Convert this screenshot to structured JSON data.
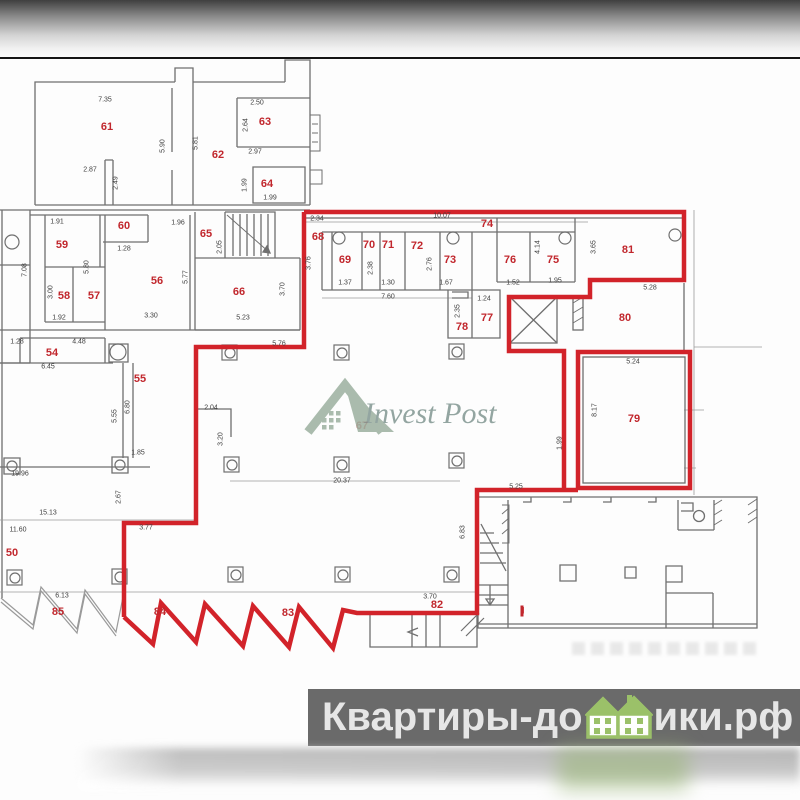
{
  "watermark": {
    "brand": "Invest Post"
  },
  "banner": {
    "left": "Квартиры-до",
    "right": "ики.рф"
  },
  "colors": {
    "highlight_red": "#d2232a",
    "room_label_red": "#c1272d",
    "wall_gray": "#6f6f6f",
    "banner_bg": "#6a6a6a",
    "banner_text": "#e6e6e6",
    "banner_house_green": "#9bc169",
    "logo_sage": "#9fb3a3"
  },
  "plan": {
    "rooms": [
      {
        "label": "61",
        "x": 107,
        "y": 127
      },
      {
        "label": "62",
        "x": 218,
        "y": 155
      },
      {
        "label": "63",
        "x": 265,
        "y": 122
      },
      {
        "label": "64",
        "x": 267,
        "y": 184
      },
      {
        "label": "59",
        "x": 62,
        "y": 245
      },
      {
        "label": "60",
        "x": 124,
        "y": 226
      },
      {
        "label": "65",
        "x": 206,
        "y": 234
      },
      {
        "label": "56",
        "x": 157,
        "y": 281
      },
      {
        "label": "58",
        "x": 64,
        "y": 296
      },
      {
        "label": "57",
        "x": 94,
        "y": 296
      },
      {
        "label": "66",
        "x": 239,
        "y": 292
      },
      {
        "label": "54",
        "x": 52,
        "y": 353
      },
      {
        "label": "55",
        "x": 140,
        "y": 379
      },
      {
        "label": "50",
        "x": 12,
        "y": 553
      },
      {
        "label": "85",
        "x": 58,
        "y": 612
      },
      {
        "label": "84",
        "x": 160,
        "y": 612
      },
      {
        "label": "83",
        "x": 288,
        "y": 613
      },
      {
        "label": "82",
        "x": 437,
        "y": 605
      },
      {
        "label": "68",
        "x": 318,
        "y": 237
      },
      {
        "label": "69",
        "x": 345,
        "y": 260
      },
      {
        "label": "70",
        "x": 369,
        "y": 245
      },
      {
        "label": "71",
        "x": 388,
        "y": 245
      },
      {
        "label": "72",
        "x": 417,
        "y": 246
      },
      {
        "label": "73",
        "x": 450,
        "y": 260
      },
      {
        "label": "74",
        "x": 487,
        "y": 224
      },
      {
        "label": "76",
        "x": 510,
        "y": 260
      },
      {
        "label": "75",
        "x": 553,
        "y": 260
      },
      {
        "label": "77",
        "x": 487,
        "y": 318
      },
      {
        "label": "78",
        "x": 462,
        "y": 327
      },
      {
        "label": "81",
        "x": 628,
        "y": 250
      },
      {
        "label": "80",
        "x": 625,
        "y": 318
      },
      {
        "label": "79",
        "x": 634,
        "y": 419
      },
      {
        "label": "67",
        "x": 362,
        "y": 426
      },
      {
        "label": "II",
        "x": 522,
        "y": 611,
        "cls": "unit"
      }
    ],
    "dims": [
      {
        "t": "7.35",
        "x": 105,
        "y": 100
      },
      {
        "t": "2.87",
        "x": 90,
        "y": 170
      },
      {
        "t": "5.90",
        "x": 163,
        "y": 146,
        "v": 1
      },
      {
        "t": "2.49",
        "x": 116,
        "y": 183,
        "v": 1
      },
      {
        "t": "5.81",
        "x": 196,
        "y": 143,
        "v": 1
      },
      {
        "t": "2.50",
        "x": 257,
        "y": 103
      },
      {
        "t": "2.64",
        "x": 246,
        "y": 125,
        "v": 1
      },
      {
        "t": "2.97",
        "x": 255,
        "y": 152
      },
      {
        "t": "1.99",
        "x": 245,
        "y": 185,
        "v": 1
      },
      {
        "t": "1.99",
        "x": 270,
        "y": 198
      },
      {
        "t": "1.91",
        "x": 57,
        "y": 222
      },
      {
        "t": "1.96",
        "x": 178,
        "y": 223
      },
      {
        "t": "2.05",
        "x": 220,
        "y": 247,
        "v": 1
      },
      {
        "t": "5.80",
        "x": 87,
        "y": 267,
        "v": 1
      },
      {
        "t": "3.00",
        "x": 51,
        "y": 292,
        "v": 1
      },
      {
        "t": "1.92",
        "x": 59,
        "y": 318
      },
      {
        "t": "5.77",
        "x": 186,
        "y": 277,
        "v": 1
      },
      {
        "t": "3.30",
        "x": 151,
        "y": 316
      },
      {
        "t": "5.23",
        "x": 243,
        "y": 318
      },
      {
        "t": "3.70",
        "x": 283,
        "y": 289,
        "v": 1
      },
      {
        "t": "7.08",
        "x": 25,
        "y": 270,
        "v": 1
      },
      {
        "t": "1.28",
        "x": 17,
        "y": 342
      },
      {
        "t": "1.28",
        "x": 124,
        "y": 249
      },
      {
        "t": "4.48",
        "x": 79,
        "y": 342
      },
      {
        "t": "6.45",
        "x": 48,
        "y": 367
      },
      {
        "t": "5.55",
        "x": 115,
        "y": 416,
        "v": 1
      },
      {
        "t": "6.80",
        "x": 128,
        "y": 407,
        "v": 1
      },
      {
        "t": "1.85",
        "x": 138,
        "y": 453
      },
      {
        "t": "19.96",
        "x": 20,
        "y": 474
      },
      {
        "t": "15.13",
        "x": 48,
        "y": 513
      },
      {
        "t": "11.60",
        "x": 18,
        "y": 530
      },
      {
        "t": "2.67",
        "x": 119,
        "y": 497,
        "v": 1
      },
      {
        "t": "3.77",
        "x": 146,
        "y": 528
      },
      {
        "t": "6.13",
        "x": 62,
        "y": 596
      },
      {
        "t": "2.04",
        "x": 211,
        "y": 408
      },
      {
        "t": "3.20",
        "x": 221,
        "y": 439,
        "v": 1
      },
      {
        "t": "5.76",
        "x": 279,
        "y": 344
      },
      {
        "t": "20.37",
        "x": 342,
        "y": 481
      },
      {
        "t": "2.34",
        "x": 317,
        "y": 219
      },
      {
        "t": "3.76",
        "x": 309,
        "y": 263,
        "v": 1
      },
      {
        "t": "10.07",
        "x": 442,
        "y": 216
      },
      {
        "t": "1.37",
        "x": 345,
        "y": 283
      },
      {
        "t": "2.38",
        "x": 371,
        "y": 268,
        "v": 1
      },
      {
        "t": "1.30",
        "x": 388,
        "y": 283
      },
      {
        "t": "2.76",
        "x": 430,
        "y": 264,
        "v": 1
      },
      {
        "t": "1.67",
        "x": 446,
        "y": 283
      },
      {
        "t": "7.60",
        "x": 388,
        "y": 297
      },
      {
        "t": "1.52",
        "x": 513,
        "y": 283
      },
      {
        "t": "4.14",
        "x": 538,
        "y": 247,
        "v": 1
      },
      {
        "t": "1.95",
        "x": 555,
        "y": 281
      },
      {
        "t": "3.65",
        "x": 594,
        "y": 247,
        "v": 1
      },
      {
        "t": "1.24",
        "x": 484,
        "y": 299
      },
      {
        "t": "2.35",
        "x": 458,
        "y": 311,
        "v": 1
      },
      {
        "t": "5.28",
        "x": 650,
        "y": 288
      },
      {
        "t": "5.25",
        "x": 516,
        "y": 487
      },
      {
        "t": "5.24",
        "x": 633,
        "y": 362
      },
      {
        "t": "8.17",
        "x": 595,
        "y": 410,
        "v": 1
      },
      {
        "t": "1.99",
        "x": 560,
        "y": 443,
        "v": 1
      },
      {
        "t": "6.83",
        "x": 463,
        "y": 532,
        "v": 1
      },
      {
        "t": "3.70",
        "x": 430,
        "y": 597
      }
    ]
  }
}
